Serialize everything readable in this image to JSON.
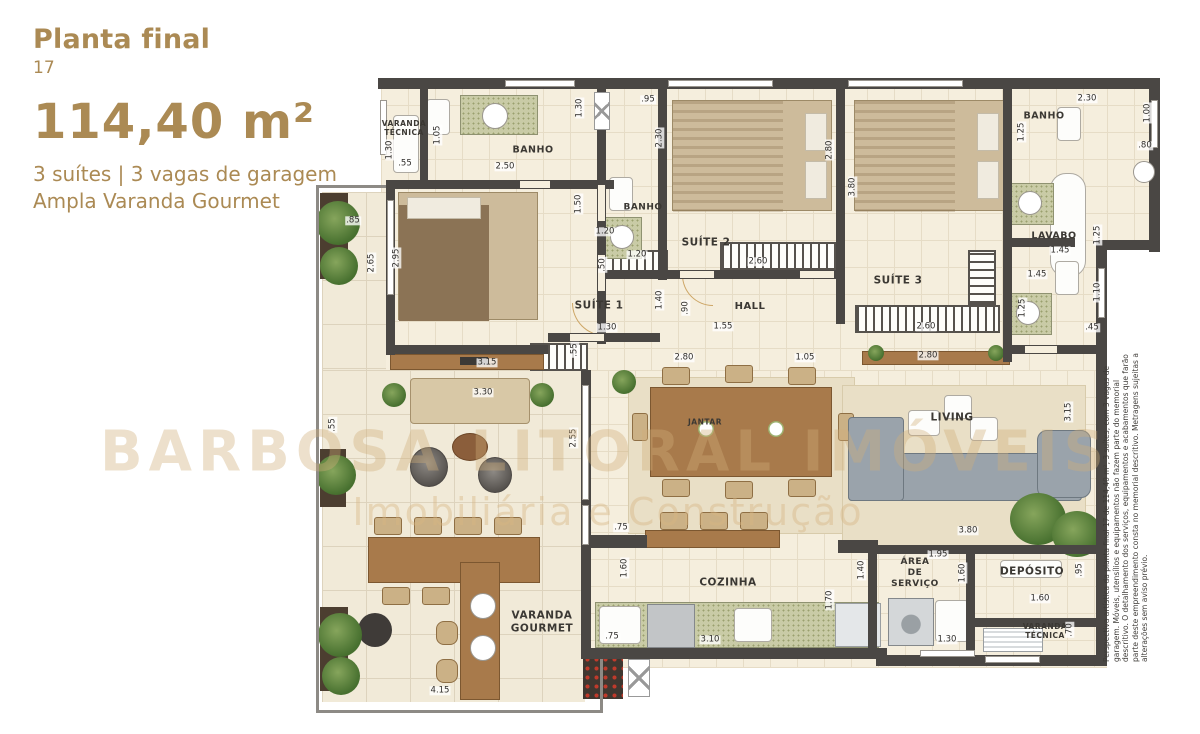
{
  "header": {
    "title": "Planta final",
    "plan_number": "17",
    "area": "114,40 m²",
    "features_line1": "3 suítes  | 3 vagas de garagem",
    "features_line2": "Ampla Varanda Gourmet"
  },
  "watermark": {
    "line1": "BARBOSA LITORAL IMÓVEIS",
    "line2": "Imobiliária e Construção"
  },
  "disclaimer": "Perspectiva artística da planta final 17 de 114,40 m², 3 suítes, com 3 vagas de garagem. Móveis, utensílios e equipamentos não fazem parte do memorial descritivo. O detalhamento dos serviços, equipamentos e acabamentos que farão parte deste empreendimento consta no memorial descritivo. Metragens sujeitas a alterações sem aviso prévio.",
  "colors": {
    "accent_gold": "#ab8a54",
    "wall_dark": "#4a4744",
    "floor_cream": "#f5eedd",
    "wood_brown": "#a87a4b",
    "watermark_tan": "#d0ad78"
  },
  "plan": {
    "room_labels": [
      {
        "id": "varanda-tecnica-top",
        "label": "VARANDA\nTÉCNICA",
        "x": 94,
        "y": 63,
        "fs": 7.5
      },
      {
        "id": "banho-suite1",
        "label": "BANHO",
        "x": 223,
        "y": 85,
        "fs": 9.5
      },
      {
        "id": "banho-suite2",
        "label": "BANHO",
        "x": 333,
        "y": 143,
        "fs": 9
      },
      {
        "id": "suite-2",
        "label": "SUÍTE 2",
        "x": 396,
        "y": 178,
        "fs": 10.5
      },
      {
        "id": "suite-3",
        "label": "SUÍTE 3",
        "x": 588,
        "y": 216,
        "fs": 10.5
      },
      {
        "id": "suite-1",
        "label": "SUÍTE 1",
        "x": 289,
        "y": 241,
        "fs": 10.5
      },
      {
        "id": "hall",
        "label": "HALL",
        "x": 440,
        "y": 242,
        "fs": 10
      },
      {
        "id": "banho-suite3",
        "label": "BANHO",
        "x": 734,
        "y": 51,
        "fs": 9.5
      },
      {
        "id": "lavabo",
        "label": "LAVABO",
        "x": 744,
        "y": 171,
        "fs": 9.5
      },
      {
        "id": "jantar",
        "label": "JANTAR",
        "x": 395,
        "y": 357,
        "fs": 7.5
      },
      {
        "id": "living",
        "label": "LIVING",
        "x": 642,
        "y": 353,
        "fs": 10.5
      },
      {
        "id": "cozinha",
        "label": "COZINHA",
        "x": 418,
        "y": 518,
        "fs": 10.5
      },
      {
        "id": "area-de-servico",
        "label": "ÁREA\nDE\nSERVIÇO",
        "x": 605,
        "y": 508,
        "fs": 9
      },
      {
        "id": "deposito",
        "label": "DEPÓSITO",
        "x": 722,
        "y": 507,
        "fs": 10.5
      },
      {
        "id": "varanda-tecnica-bottom",
        "label": "VARANDA\nTÉCNICA",
        "x": 735,
        "y": 566,
        "fs": 7.5
      },
      {
        "id": "varanda-gourmet",
        "label": "VARANDA\nGOURMET",
        "x": 232,
        "y": 557,
        "fs": 10.5
      }
    ],
    "dimension_labels": [
      {
        "t": "1.30",
        "x": 80,
        "y": 85,
        "r": 1
      },
      {
        "t": ".55",
        "x": 95,
        "y": 99
      },
      {
        "t": "1.05",
        "x": 128,
        "y": 70,
        "r": 1
      },
      {
        "t": "2.50",
        "x": 195,
        "y": 102
      },
      {
        "t": "1.30",
        "x": 270,
        "y": 43,
        "r": 1
      },
      {
        "t": ".95",
        "x": 338,
        "y": 35
      },
      {
        "t": "2.30",
        "x": 350,
        "y": 73,
        "r": 1
      },
      {
        "t": "1.50",
        "x": 269,
        "y": 139,
        "r": 1
      },
      {
        "t": "1.20",
        "x": 295,
        "y": 167
      },
      {
        "t": ".50",
        "x": 293,
        "y": 200,
        "r": 1
      },
      {
        "t": "1.20",
        "x": 327,
        "y": 190
      },
      {
        "t": "2.95",
        "x": 87,
        "y": 193,
        "r": 1
      },
      {
        "t": "2.65",
        "x": 62,
        "y": 198,
        "r": 1
      },
      {
        "t": ".85",
        "x": 43,
        "y": 156
      },
      {
        "t": "2.80",
        "x": 520,
        "y": 85,
        "r": 1
      },
      {
        "t": "3.80",
        "x": 543,
        "y": 122,
        "r": 1
      },
      {
        "t": "2.60",
        "x": 448,
        "y": 197
      },
      {
        "t": "2.60",
        "x": 616,
        "y": 262
      },
      {
        "t": "1.40",
        "x": 350,
        "y": 235,
        "r": 1
      },
      {
        "t": ".90",
        "x": 376,
        "y": 243,
        "r": 1
      },
      {
        "t": "1.55",
        "x": 413,
        "y": 262
      },
      {
        "t": "1.30",
        "x": 297,
        "y": 263
      },
      {
        "t": ".55",
        "x": 265,
        "y": 285,
        "r": 1
      },
      {
        "t": "3.15",
        "x": 177,
        "y": 298
      },
      {
        "t": "3.30",
        "x": 173,
        "y": 328
      },
      {
        "t": "2.30",
        "x": 777,
        "y": 34
      },
      {
        "t": "1.00",
        "x": 838,
        "y": 48,
        "r": 1
      },
      {
        "t": ".80",
        "x": 835,
        "y": 81
      },
      {
        "t": "1.25",
        "x": 712,
        "y": 67,
        "r": 1
      },
      {
        "t": "1.45",
        "x": 750,
        "y": 186
      },
      {
        "t": "1.25",
        "x": 788,
        "y": 170,
        "r": 1
      },
      {
        "t": "1.45",
        "x": 727,
        "y": 210
      },
      {
        "t": "1.10",
        "x": 788,
        "y": 227,
        "r": 1
      },
      {
        "t": "1.25",
        "x": 713,
        "y": 243,
        "r": 1
      },
      {
        "t": ".45",
        "x": 782,
        "y": 263
      },
      {
        "t": "2.80",
        "x": 374,
        "y": 293
      },
      {
        "t": "1.05",
        "x": 495,
        "y": 293
      },
      {
        "t": "2.80",
        "x": 618,
        "y": 291
      },
      {
        "t": "3.15",
        "x": 759,
        "y": 347,
        "r": 1
      },
      {
        "t": "2.55",
        "x": 264,
        "y": 373,
        "r": 1
      },
      {
        "t": "3.80",
        "x": 658,
        "y": 466
      },
      {
        "t": "1.95",
        "x": 628,
        "y": 490
      },
      {
        "t": ".75",
        "x": 311,
        "y": 463
      },
      {
        "t": "1.60",
        "x": 315,
        "y": 503,
        "r": 1
      },
      {
        "t": "1.70",
        "x": 520,
        "y": 535,
        "r": 1
      },
      {
        "t": "1.40",
        "x": 552,
        "y": 505,
        "r": 1
      },
      {
        "t": ".75",
        "x": 302,
        "y": 572
      },
      {
        "t": "3.10",
        "x": 400,
        "y": 575
      },
      {
        "t": "1.60",
        "x": 653,
        "y": 508,
        "r": 1
      },
      {
        "t": ".95",
        "x": 770,
        "y": 505,
        "r": 1
      },
      {
        "t": "1.60",
        "x": 730,
        "y": 534
      },
      {
        "t": ".70",
        "x": 760,
        "y": 565,
        "r": 1
      },
      {
        "t": "1.30",
        "x": 637,
        "y": 575
      },
      {
        "t": "4.15",
        "x": 130,
        "y": 626
      },
      {
        "t": ".55",
        "x": 23,
        "y": 360,
        "r": 1
      }
    ]
  }
}
